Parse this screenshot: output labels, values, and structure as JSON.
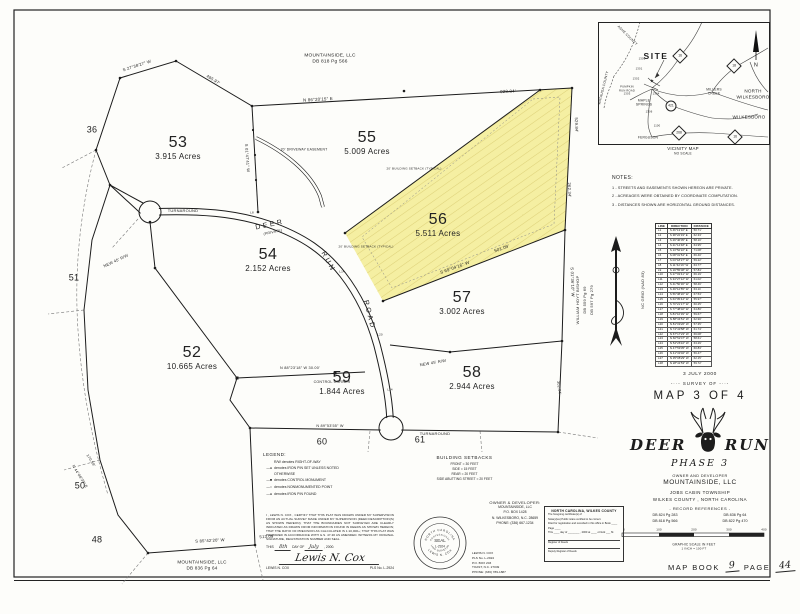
{
  "sheet": {
    "background": "#fdfdfa",
    "ink": "#1c1c1c",
    "highlight": "#f5efa2",
    "hatch": "#d9cc72"
  },
  "plat": {
    "lots": [
      {
        "number": "53",
        "acres": "3.915 Acres",
        "x": 178,
        "y": 148
      },
      {
        "number": "55",
        "acres": "5.009 Acres",
        "x": 367,
        "y": 143
      },
      {
        "number": "56",
        "acres": "5.511 Acres",
        "x": 438,
        "y": 225
      },
      {
        "number": "54",
        "acres": "2.152 Acres",
        "x": 268,
        "y": 260
      },
      {
        "number": "57",
        "acres": "3.002 Acres",
        "x": 462,
        "y": 303
      },
      {
        "number": "52",
        "acres": "10.665 Acres",
        "x": 192,
        "y": 358
      },
      {
        "number": "59",
        "acres": "1.844 Acres",
        "x": 342,
        "y": 383
      },
      {
        "number": "58",
        "acres": "2.944 Acres",
        "x": 472,
        "y": 378
      }
    ]
  },
  "labels": [
    {
      "t": "MOUNTAINSIDE, LLC",
      "x": 330,
      "y": 57,
      "fs": 4.8
    },
    {
      "t": "DB 818 Pg 566",
      "x": 330,
      "y": 63,
      "fs": 4.8
    },
    {
      "t": "MOUNTAINSIDE, LLC",
      "x": 202,
      "y": 563,
      "fs": 4.6
    },
    {
      "t": "DB 836 Pg 64",
      "x": 202,
      "y": 569,
      "fs": 4.6
    },
    {
      "t": "N 86°20'15\" E",
      "x": 318,
      "y": 100,
      "r": -3,
      "fs": 4.4
    },
    {
      "t": "928.84'",
      "x": 508,
      "y": 92,
      "r": -2,
      "fs": 4.4
    },
    {
      "t": "495.97'",
      "x": 213,
      "y": 80,
      "r": 31,
      "fs": 4.2
    },
    {
      "t": "S 27°38'27\" W",
      "x": 137,
      "y": 66,
      "r": -18,
      "fs": 4.2
    },
    {
      "t": "S 01°47'41\" W",
      "x": 247,
      "y": 158,
      "r": 86,
      "fs": 4
    },
    {
      "t": "529.84'",
      "x": 576,
      "y": 125,
      "r": 88,
      "fs": 4.2
    },
    {
      "t": "262.34'",
      "x": 569,
      "y": 190,
      "r": 88,
      "fs": 4.2
    },
    {
      "t": "S 01°36'10\" W",
      "x": 572,
      "y": 282,
      "r": 88,
      "fs": 4.2
    },
    {
      "t": "S 69°04'16\" W",
      "x": 455,
      "y": 268,
      "r": -20,
      "fs": 4.4
    },
    {
      "t": "501.09'",
      "x": 502,
      "y": 249,
      "r": -20,
      "fs": 4.4
    },
    {
      "t": "N 88°23'18\" W  30.00'",
      "x": 300,
      "y": 369,
      "fs": 3.8
    },
    {
      "t": "CONTROL CORNER",
      "x": 332,
      "y": 383,
      "fs": 3.6
    },
    {
      "t": "S 85°42'20\" W",
      "x": 210,
      "y": 541,
      "r": -3,
      "fs": 4.2
    },
    {
      "t": "513.09'",
      "x": 267,
      "y": 537,
      "r": -3,
      "fs": 4.2
    },
    {
      "t": "N 44°08'39\" E",
      "x": 79,
      "y": 477,
      "r": 58,
      "fs": 3.8
    },
    {
      "t": "170.59'",
      "x": 90,
      "y": 461,
      "r": 58,
      "fs": 3.8
    },
    {
      "t": "302.04'",
      "x": 558,
      "y": 388,
      "r": 82,
      "fs": 3.8
    },
    {
      "t": "N 89°53'55\" W",
      "x": 330,
      "y": 427,
      "fs": 3.8
    },
    {
      "t": "NEW 45' R/W",
      "x": 116,
      "y": 261,
      "r": -25,
      "fs": 4
    },
    {
      "t": "NEW 45' R/W",
      "x": 433,
      "y": 363,
      "r": -10,
      "fs": 4
    },
    {
      "t": "TURNAROUND",
      "x": 183,
      "y": 211,
      "fs": 4
    },
    {
      "t": "TURNAROUND",
      "x": 435,
      "y": 434,
      "fs": 4
    },
    {
      "t": "DEER",
      "x": 270,
      "y": 225,
      "r": -12,
      "fs": 7,
      "c": "road"
    },
    {
      "t": "(PRIVATE)",
      "x": 273,
      "y": 233,
      "r": -12,
      "fs": 3.6,
      "c": "it"
    },
    {
      "t": "RUN",
      "x": 328,
      "y": 262,
      "r": 62,
      "fs": 7,
      "c": "road"
    },
    {
      "t": "ROAD",
      "x": 369,
      "y": 315,
      "r": 76,
      "fs": 7,
      "c": "road"
    },
    {
      "t": "20' DRIVEWAY EASEMENT",
      "x": 304,
      "y": 150,
      "fs": 3.4
    },
    {
      "t": "20' BUILDING SETBACK (TYPICAL)",
      "x": 414,
      "y": 169,
      "fs": 3
    },
    {
      "t": "20' BUILDING SETBACK (TYPICAL)",
      "x": 366,
      "y": 247,
      "fs": 3
    },
    {
      "t": "36",
      "x": 92,
      "y": 130,
      "fs": 9
    },
    {
      "t": "51",
      "x": 74,
      "y": 278,
      "fs": 9
    },
    {
      "t": "50",
      "x": 80,
      "y": 486,
      "fs": 9
    },
    {
      "t": "48",
      "x": 97,
      "y": 540,
      "fs": 9
    },
    {
      "t": "60",
      "x": 322,
      "y": 442,
      "fs": 9
    },
    {
      "t": "61",
      "x": 420,
      "y": 440,
      "fs": 9
    },
    {
      "t": "L8",
      "x": 252,
      "y": 213,
      "fs": 3
    },
    {
      "t": "L14",
      "x": 342,
      "y": 272,
      "fs": 3
    },
    {
      "t": "L20",
      "x": 380,
      "y": 335,
      "fs": 3
    },
    {
      "t": "L24",
      "x": 390,
      "y": 390,
      "fs": 3
    },
    {
      "t": "WILLIAM HOYT BISHOP",
      "x": 578,
      "y": 300,
      "r": -90,
      "fs": 4
    },
    {
      "t": "DB 559 Pg 69",
      "x": 585,
      "y": 300,
      "r": -90,
      "fs": 4
    },
    {
      "t": "DB 597 Pg 279",
      "x": 592,
      "y": 300,
      "r": -90,
      "fs": 4
    },
    {
      "t": "NC GRID (NAD 83)",
      "x": 643,
      "y": 290,
      "r": -90,
      "fs": 4
    },
    {
      "t": "SITE",
      "x": 656,
      "y": 56,
      "fs": 8.5,
      "c": "site"
    },
    {
      "t": "★",
      "x": 652,
      "y": 82,
      "fs": 5
    },
    {
      "t": "NORTH",
      "x": 753,
      "y": 92,
      "fs": 4.6
    },
    {
      "t": "WILKESBORO",
      "x": 753,
      "y": 98,
      "fs": 4.6
    },
    {
      "t": "WILKESBORO",
      "x": 749,
      "y": 118,
      "fs": 4.6
    },
    {
      "t": "MILLERS",
      "x": 714,
      "y": 90,
      "fs": 3.3
    },
    {
      "t": "CREEK",
      "x": 714,
      "y": 94,
      "fs": 3.3
    },
    {
      "t": "MAPLE",
      "x": 644,
      "y": 101,
      "fs": 3.3
    },
    {
      "t": "SPRINGS",
      "x": 644,
      "y": 105,
      "fs": 3.3
    },
    {
      "t": "FERGUSON",
      "x": 648,
      "y": 138,
      "fs": 3.3
    },
    {
      "t": "ASHE COUNTY",
      "x": 627,
      "y": 36,
      "r": 45,
      "fs": 3.4
    },
    {
      "t": "WATAUGA COUNTY",
      "x": 604,
      "y": 88,
      "r": -76,
      "fs": 3.4
    },
    {
      "t": "PUMPKIN",
      "x": 627,
      "y": 88,
      "fs": 2.7
    },
    {
      "t": "RUN ROAD",
      "x": 627,
      "y": 91.5,
      "fs": 2.7
    },
    {
      "t": "1303",
      "x": 627,
      "y": 95,
      "fs": 2.7
    },
    {
      "t": "1300",
      "x": 642,
      "y": 60,
      "fs": 2.7
    },
    {
      "t": "1301",
      "x": 639,
      "y": 70,
      "fs": 2.7
    },
    {
      "t": "1302",
      "x": 636,
      "y": 80,
      "fs": 2.7
    },
    {
      "t": "1304",
      "x": 656,
      "y": 95,
      "fs": 2.7
    },
    {
      "t": "1306",
      "x": 649,
      "y": 113,
      "fs": 2.7
    },
    {
      "t": "1100",
      "x": 657,
      "y": 127,
      "fs": 2.7
    },
    {
      "t": "N",
      "x": 756,
      "y": 66,
      "fs": 5.5
    },
    {
      "t": "VICINITY MAP",
      "x": 683,
      "y": 149,
      "fs": 4.4
    },
    {
      "t": "NO SCALE",
      "x": 683,
      "y": 154,
      "fs": 3.2
    },
    {
      "t": "0",
      "x": 624,
      "y": 530,
      "fs": 3
    },
    {
      "t": "100",
      "x": 659,
      "y": 530,
      "fs": 3
    },
    {
      "t": "200",
      "x": 694,
      "y": 530,
      "fs": 3
    },
    {
      "t": "300",
      "x": 729,
      "y": 530,
      "fs": 3
    },
    {
      "t": "400",
      "x": 764,
      "y": 530,
      "fs": 3
    },
    {
      "t": "GRAPHIC SCALE IN FEET",
      "x": 694,
      "y": 545,
      "fs": 3.2
    },
    {
      "t": "1 INCH = 100 FT",
      "x": 694,
      "y": 549,
      "fs": 2.9
    }
  ],
  "vicinity": {
    "shields": [
      {
        "n": "16",
        "x": 680,
        "y": 56
      },
      {
        "n": "18",
        "x": 734,
        "y": 66
      },
      {
        "n": "421",
        "x": 671,
        "y": 106,
        "shape": "oval"
      },
      {
        "n": "268",
        "x": 679,
        "y": 133
      },
      {
        "n": "16",
        "x": 735,
        "y": 137
      }
    ]
  },
  "notes": {
    "title": "NOTES:",
    "items": [
      "1 - STREETS AND EASEMENTS SHOWN HEREON ARE PRIVATE.",
      "2 - ACREAGES WERE OBTAINED BY COORDINATE COMPUTATION.",
      "3 - DISTANCES SHOWN ARE HORIZONTAL GROUND DISTANCES."
    ]
  },
  "line_table": {
    "headers": [
      "LINE",
      "DIRECTION",
      "DISTANCE"
    ],
    "rows": [
      [
        "L1",
        "S 46°13'10\" E",
        "50.71'"
      ],
      [
        "L2",
        "S 38°22'33\" E",
        "62.33'"
      ],
      [
        "L3",
        "S 29°46'05\" E",
        "58.10'"
      ],
      [
        "L4",
        "S 21°14'48\" E",
        "64.95'"
      ],
      [
        "L5",
        "S 13°52'22\" E",
        "71.08'"
      ],
      [
        "L6",
        "S 08°31'54\" E",
        "66.40'"
      ],
      [
        "L7",
        "S 03°18'27\" W",
        "59.22'"
      ],
      [
        "L8",
        "S 11°42'16\" W",
        "63.77'"
      ],
      [
        "L9",
        "S 19°55'08\" W",
        "57.84'"
      ],
      [
        "L10",
        "S 27°03'41\" W",
        "66.19'"
      ],
      [
        "L11",
        "S 34°27'12\" W",
        "61.02'"
      ],
      [
        "L12",
        "S 41°50'36\" W",
        "58.46'"
      ],
      [
        "L13",
        "S 49°12'55\" W",
        "63.11'"
      ],
      [
        "L14",
        "S 56°38'20\" W",
        "67.53'"
      ],
      [
        "L15",
        "S 63°05'44\" W",
        "55.97'"
      ],
      [
        "L16",
        "S 70°21'17\" W",
        "60.25'"
      ],
      [
        "L17",
        "S 77°48'02\" W",
        "64.80'"
      ],
      [
        "L18",
        "S 84°16'39\" W",
        "59.67'"
      ],
      [
        "L19",
        "N 88°34'51\" W",
        "62.90'"
      ],
      [
        "L20",
        "N 81°09'26\" W",
        "57.35'"
      ],
      [
        "L21",
        "N 74°43'58\" W",
        "61.74'"
      ],
      [
        "L22",
        "N 67°17'23\" W",
        "66.08'"
      ],
      [
        "L23",
        "N 60°52'47\" W",
        "58.61'"
      ],
      [
        "L24",
        "N 54°26'10\" W",
        "63.29'"
      ],
      [
        "L25",
        "N 47°59'35\" W",
        "60.83'"
      ],
      [
        "L26",
        "N 41°33'02\" W",
        "56.47'"
      ],
      [
        "L27",
        "N 35°08'29\" W",
        "62.15'"
      ],
      [
        "L28",
        "N 28°41'53\" W",
        "59.72'"
      ]
    ]
  },
  "title_block": {
    "date": "3 JULY 2000",
    "survey_of": "-··- SURVEY OF -··-",
    "map_of": "MAP 3 OF 4",
    "name_left": "DEER",
    "name_right": "RUN",
    "phase": "PHASE 3",
    "owner_label": "OWNER AND DEVELOPER",
    "owner": "MOUNTAINSIDE, LLC",
    "township": "JOBS CABIN TOWNSHIP",
    "county": "WILKES COUNTY , NORTH CAROLINA",
    "records_label": "- RECORD REFERENCES -",
    "records": [
      "DB 824 Pg 283",
      "DB 836 Pg 64",
      "DB 818 Pg 566",
      "DB 822 Pg 470"
    ]
  },
  "legend": {
    "title": "LEGEND:",
    "items": [
      {
        "glyph": "none",
        "text": "R/W denotes RIGHT-OF-WAY"
      },
      {
        "glyph": "pin",
        "text": "denotes IRON PIN SET UNLESS NOTED OTHERWISE"
      },
      {
        "glyph": "square",
        "text": "denotes CONTROL MONUMENT"
      },
      {
        "glyph": "open",
        "text": "denotes NONMONUMENTED POINT"
      },
      {
        "glyph": "pin",
        "text": "denotes IRON PIN FOUND"
      }
    ]
  },
  "setbacks": {
    "title": "BUILDING SETBACKS",
    "items": [
      "FRONT = 30 FEET",
      "SIDE = 15 FEET",
      "REAR = 20 FEET",
      "SIDE ABUTTING STREET = 20 FEET"
    ]
  },
  "owner_block": {
    "title": "OWNER & DEVELOPER:",
    "lines": [
      "MOUNTAINSIDE, LLC",
      "P.O. BOX 1428",
      "N. WILKESBORO, N.C. 28659",
      "PHONE: (336) 667-1234"
    ]
  },
  "surveyor_block": {
    "lines": [
      "LEWIS N. COX",
      "PLS No. L-2924",
      "P.O. BOX 203",
      "TOAST, N.C. 27049",
      "PHONE: (336) 789-1887"
    ]
  },
  "certificate": {
    "body": "I , LEWIS N. COX , CERTIFY THAT THIS PLAT WAS DRAWN UNDER MY SUPERVISION FROM AN ACTUAL SURVEY MADE UNDER MY SUPERVISION (DEED DESCRIPTION(S) AS SHOWN HEREON); THAT THE BOUNDARIES NOT SURVEYED ARE CLEARLY INDICATED AS DRAWN FROM INFORMATION FOUND IN DEEDS AS SHOWN HEREON; THAT THE RATIO OF PRECISION AS CALCULATED IS 1:10,000+; THAT THIS PLAT WAS PREPARED IN ACCORDANCE WITH G.S. 47-30 AS AMENDED. WITNESS MY ORIGINAL SIGNATURE, REGISTRATION NUMBER AND SEAL.",
    "date_pre": "THIS",
    "date_day": "8th",
    "date_mid": "DAY OF",
    "date_month": "July",
    "date_post": ", 2000.",
    "signature": "Lewis N. Cox",
    "name": "LEWIS N. COX",
    "pls": "PLS No. L-2924"
  },
  "seal": {
    "top": "NORTH CAROLINA",
    "bottom": "LEWIS N. COX",
    "inner_top": "PROFESSIONAL",
    "line1": "SEAL",
    "line2": "L-2924",
    "inner_bottom": "LAND SURVEYOR"
  },
  "registration": {
    "title": "NORTH CAROLINA, WILKES COUNTY",
    "l1": "The foregoing certificate(s) of",
    "l2": "Notary(ies) Public is/are certified to be correct.",
    "l3": "Filed for registration and recorded in this office in Book ____ Page ____",
    "l4": "This ____ day of ________ , 2000 at ____ o'clock ___ M.",
    "sig1": "Register of Deeds",
    "sig2": "Deputy Register of Deeds"
  },
  "map_book": {
    "l1": "MAP BOOK",
    "book": "9",
    "l2": "PAGE",
    "page": "44"
  }
}
